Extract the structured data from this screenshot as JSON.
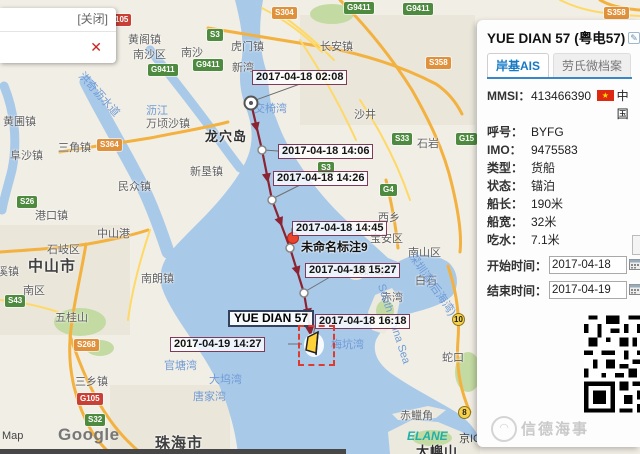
{
  "colors": {
    "accent_blue": "#1779c4",
    "track_red": "#8b2332",
    "box_border": "#7d3a5a",
    "water": "#a9c9e9",
    "select_red": "#e03a2f"
  },
  "popup": {
    "close_label": "[关闭]",
    "x_icon": "✕"
  },
  "map": {
    "attribution": {
      "map": "Map",
      "google": "Google",
      "elane": "ELANE",
      "icp": "京IC"
    },
    "badges": [
      {
        "text": "105",
        "type": "red",
        "x": 112,
        "y": 14
      },
      {
        "text": "S304",
        "type": "orange",
        "x": 272,
        "y": 7
      },
      {
        "text": "G9411",
        "type": "green",
        "x": 344,
        "y": 2
      },
      {
        "text": "G9411",
        "type": "green",
        "x": 403,
        "y": 3
      },
      {
        "text": "S3",
        "type": "green",
        "x": 207,
        "y": 29
      },
      {
        "text": "S358",
        "type": "orange",
        "x": 604,
        "y": 7
      },
      {
        "text": "S358",
        "type": "orange",
        "x": 426,
        "y": 57
      },
      {
        "text": "G9411",
        "type": "green",
        "x": 148,
        "y": 64
      },
      {
        "text": "G9411",
        "type": "green",
        "x": 193,
        "y": 59
      },
      {
        "text": "S33",
        "type": "green",
        "x": 392,
        "y": 133
      },
      {
        "text": "G15",
        "type": "green",
        "x": 456,
        "y": 133
      },
      {
        "text": "S364",
        "type": "orange",
        "x": 97,
        "y": 139
      },
      {
        "text": "S3",
        "type": "green",
        "x": 318,
        "y": 162
      },
      {
        "text": "G4",
        "type": "green",
        "x": 380,
        "y": 184
      },
      {
        "text": "S26",
        "type": "green",
        "x": 17,
        "y": 196
      },
      {
        "text": "S43",
        "type": "green",
        "x": 5,
        "y": 295
      },
      {
        "text": "S268",
        "type": "orange",
        "x": 74,
        "y": 339
      },
      {
        "text": "G105",
        "type": "red",
        "x": 77,
        "y": 393
      },
      {
        "text": "S32",
        "type": "green",
        "x": 85,
        "y": 414
      },
      {
        "text": "10",
        "type": "circle",
        "x": 452,
        "y": 313
      },
      {
        "text": "8",
        "type": "circle",
        "x": 458,
        "y": 406
      }
    ],
    "labels": [
      {
        "text": "黄阁镇",
        "x": 128,
        "y": 31,
        "cls": ""
      },
      {
        "text": "南沙区",
        "x": 133,
        "y": 46,
        "cls": ""
      },
      {
        "text": "南沙",
        "x": 181,
        "y": 44,
        "cls": ""
      },
      {
        "text": "虎门镇",
        "x": 231,
        "y": 38,
        "cls": ""
      },
      {
        "text": "新湾",
        "x": 232,
        "y": 59,
        "cls": ""
      },
      {
        "text": "长安镇",
        "x": 320,
        "y": 38,
        "cls": ""
      },
      {
        "text": "沙井",
        "x": 354,
        "y": 106,
        "cls": ""
      },
      {
        "text": "石岩",
        "x": 417,
        "y": 135,
        "cls": ""
      },
      {
        "text": "黄圃镇",
        "x": 3,
        "y": 113,
        "cls": ""
      },
      {
        "text": "万顷沙镇",
        "x": 146,
        "y": 115,
        "cls": ""
      },
      {
        "text": "龙穴岛",
        "x": 205,
        "y": 126,
        "cls": "island"
      },
      {
        "text": "三角镇",
        "x": 58,
        "y": 139,
        "cls": ""
      },
      {
        "text": "阜沙镇",
        "x": 10,
        "y": 147,
        "cls": ""
      },
      {
        "text": "新垦镇",
        "x": 190,
        "y": 163,
        "cls": ""
      },
      {
        "text": "民众镇",
        "x": 118,
        "y": 178,
        "cls": ""
      },
      {
        "text": "港口镇",
        "x": 35,
        "y": 207,
        "cls": ""
      },
      {
        "text": "西乡",
        "x": 378,
        "y": 209,
        "cls": ""
      },
      {
        "text": "中山港",
        "x": 97,
        "y": 225,
        "cls": ""
      },
      {
        "text": "宝安区",
        "x": 370,
        "y": 230,
        "cls": ""
      },
      {
        "text": "石岐区",
        "x": 47,
        "y": 241,
        "cls": ""
      },
      {
        "text": "南山区",
        "x": 408,
        "y": 244,
        "cls": ""
      },
      {
        "text": "中山市",
        "x": 28,
        "y": 255,
        "cls": "city"
      },
      {
        "text": "沙溪镇",
        "x": -14,
        "y": 263,
        "cls": ""
      },
      {
        "text": "南朗镇",
        "x": 141,
        "y": 270,
        "cls": ""
      },
      {
        "text": "白石",
        "x": 415,
        "y": 272,
        "cls": ""
      },
      {
        "text": "南区",
        "x": 23,
        "y": 282,
        "cls": ""
      },
      {
        "text": "大铲岛",
        "x": 352,
        "y": 262,
        "cls": ""
      },
      {
        "text": "赤湾",
        "x": 381,
        "y": 289,
        "cls": ""
      },
      {
        "text": "五桂山",
        "x": 55,
        "y": 309,
        "cls": ""
      },
      {
        "text": "蛇口",
        "x": 442,
        "y": 349,
        "cls": ""
      },
      {
        "text": "三乡镇",
        "x": 75,
        "y": 373,
        "cls": ""
      },
      {
        "text": "赤鱲角",
        "x": 400,
        "y": 407,
        "cls": ""
      },
      {
        "text": "珠海市",
        "x": 155,
        "y": 432,
        "cls": "city"
      },
      {
        "text": "大嶼山",
        "x": 416,
        "y": 441,
        "cls": "island"
      }
    ],
    "water": [
      {
        "text": "洪奇沥水道",
        "x": 72,
        "y": 86,
        "rot": 48
      },
      {
        "text": "沥江",
        "x": 146,
        "y": 102,
        "rot": 0
      },
      {
        "text": "交椅湾",
        "x": 254,
        "y": 100,
        "rot": 0
      },
      {
        "text": "深圳湾(后海湾)",
        "x": 396,
        "y": 276,
        "rot": 55
      },
      {
        "text": "South China Sea",
        "x": 352,
        "y": 318,
        "rot": 72
      },
      {
        "text": "梅坑湾",
        "x": 331,
        "y": 336,
        "rot": 0
      },
      {
        "text": "官塘湾",
        "x": 164,
        "y": 357,
        "rot": 0
      },
      {
        "text": "大坞湾",
        "x": 209,
        "y": 371,
        "rot": 0
      },
      {
        "text": "唐家湾",
        "x": 193,
        "y": 388,
        "rot": 0
      }
    ]
  },
  "track": {
    "vessel_label": "YUE DIAN 57",
    "marker_label": "未命名标注9",
    "timestamps": [
      {
        "text": "2017-04-18 02:08",
        "x": 252,
        "y": 70
      },
      {
        "text": "2017-04-18 14:06",
        "x": 278,
        "y": 144
      },
      {
        "text": "2017-04-18 14:26",
        "x": 273,
        "y": 171
      },
      {
        "text": "2017-04-18 14:45",
        "x": 292,
        "y": 221
      },
      {
        "text": "2017-04-18 15:27",
        "x": 305,
        "y": 263
      },
      {
        "text": "2017-04-18 16:18",
        "x": 315,
        "y": 314
      },
      {
        "text": "2017-04-19 14:27",
        "x": 170,
        "y": 337
      }
    ]
  },
  "panel": {
    "title": "YUE DIAN 57",
    "subtitle": "(粤电57)",
    "edit_icon": "✎",
    "tabs": [
      {
        "label": "岸基AIS"
      },
      {
        "label": "劳氏微档案"
      }
    ],
    "fields": [
      {
        "label": "MMSI：",
        "value": "413466390",
        "flag": "★",
        "suffix": "中国"
      },
      {
        "label": "呼号：",
        "value": "BYFG"
      },
      {
        "label": "IMO：",
        "value": "9475583"
      },
      {
        "label": "类型：",
        "value": "货船"
      },
      {
        "label": "状态：",
        "value": "锚泊"
      },
      {
        "label": "船长：",
        "value": "190米"
      },
      {
        "label": "船宽：",
        "value": "32米"
      },
      {
        "label": "吃水：",
        "value": "7.1米"
      }
    ],
    "start_time": {
      "label": "开始时间：",
      "value": "2017-04-18"
    },
    "end_time": {
      "label": "结束时间：",
      "value": "2017-04-19"
    },
    "watermark": "信德海事",
    "watermark_logo": "◠"
  }
}
